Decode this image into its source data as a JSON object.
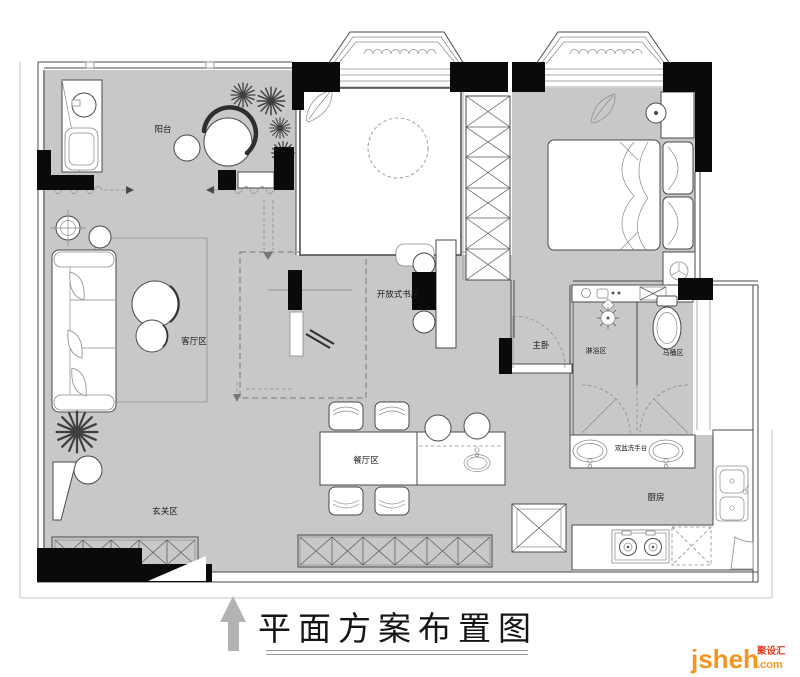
{
  "labels": {
    "balcony": "阳台",
    "living": "客厅区",
    "entry": "玄关区",
    "dining": "餐厅区",
    "study": "开放式书房",
    "master_bedroom": "主卧",
    "shower": "淋浴区",
    "toilet": "马桶区",
    "vanity": "双盆洗手台",
    "kitchen": "厨房"
  },
  "footer": {
    "title": "平面方案布置图"
  },
  "watermark": {
    "brand": "jsheh",
    "tld": ".com",
    "cn": "聚设汇"
  },
  "colors": {
    "floor_gray": "#c8c8c8",
    "wall_black": "#0a0a0a",
    "line_gray": "#4a4a4a",
    "logo_orange": "#f7941e",
    "logo_red": "#e8391c",
    "arrow_gray": "#b3b3b3"
  }
}
